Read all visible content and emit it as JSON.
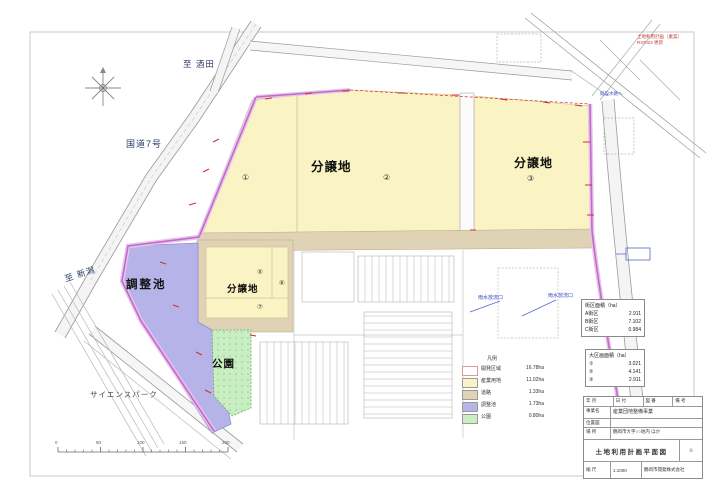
{
  "page": {
    "red_note": {
      "line1": "土地利用計画（素案）",
      "line2": "R37023 更新"
    }
  },
  "map": {
    "labels": {
      "to_sakata": "至 酒田",
      "route7": "国道7号",
      "to_niigata": "至 新潟",
      "science_park": "サイエンスパーク",
      "lot_main": "分譲地",
      "lot_east": "分譲地",
      "lot_small": "分譲地",
      "pond": "調整池",
      "park": "公園"
    },
    "lot_numbers": {
      "n1": "①",
      "n2": "②",
      "n3": "③",
      "n5": "⑤",
      "n6": "⑥",
      "n7": "⑦"
    },
    "notes": {
      "outflow1": "雨水放流口",
      "outflow2": "雨水放流口",
      "channel": "既設水路へ"
    },
    "scalebar": {
      "ticks": [
        "0",
        "50",
        "100",
        "150",
        "200"
      ]
    }
  },
  "panels": {
    "block_area": {
      "title": "街区面積（ha）",
      "rows": [
        [
          "A街区",
          "2.911"
        ],
        [
          "B街区",
          "7.102"
        ],
        [
          "C街区",
          "0.984"
        ]
      ]
    },
    "large_lots": {
      "title": "大区画面積（ha）",
      "rows": [
        [
          "①",
          "3.021"
        ],
        [
          "②",
          "4.141"
        ],
        [
          "③",
          "2.911"
        ]
      ]
    },
    "legend": {
      "title": "凡例",
      "rows": [
        {
          "label": "開発区域",
          "value": "16.78ha",
          "color": "#ffffff"
        },
        {
          "label": "産業用地",
          "value": "11.02ha",
          "color": "#faf3c4"
        },
        {
          "label": "道路",
          "value": "1.33ha",
          "color": "#e0d2b4"
        },
        {
          "label": "調整池",
          "value": "1.73ha",
          "color": "#b7b4e8"
        },
        {
          "label": "公園",
          "value": "0.80ha",
          "color": "#c9eec2"
        }
      ]
    }
  },
  "title_block": {
    "header_cells": [
      "年 月",
      "日 付",
      "図 番",
      "備 考"
    ],
    "project_label": "事業名",
    "project_value": "産業団地整備事業",
    "row3_label": "位置図",
    "location_label": "場 所",
    "location_value": "鶴岡市大字○○地内 ほか",
    "drawing_title": "土地利用計画平面図",
    "sheet_no": "①",
    "scale_label": "縮 尺",
    "scale_value": "1:1000",
    "company": "鶴岡市開発株式会社"
  }
}
